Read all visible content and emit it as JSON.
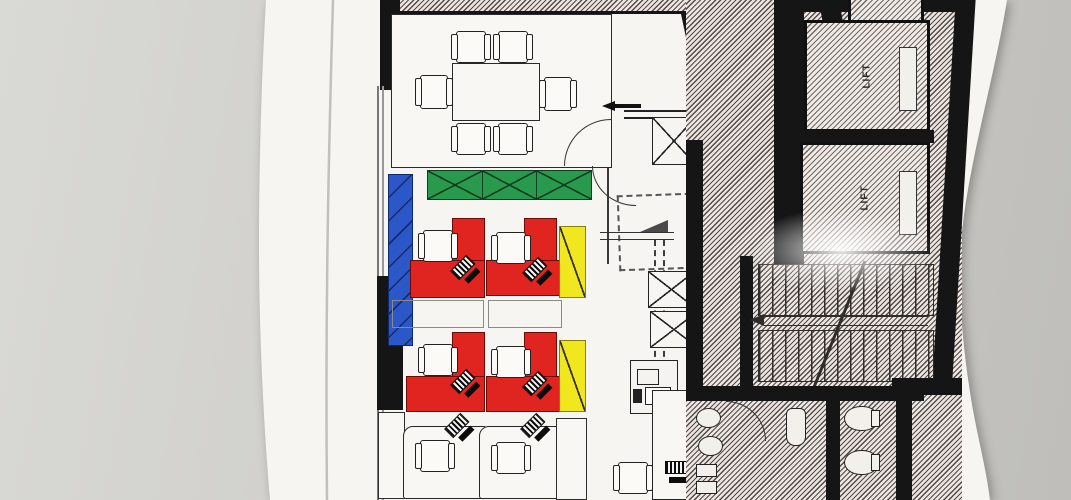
{
  "scene": {
    "background_color": "#cdccc8",
    "paper_color": "#f6f5f1"
  },
  "plan": {
    "highlight_colors": {
      "red_desks": "#e02420",
      "yellow_panels": "#f1e71f",
      "blue_cabinet": "#2b57c8",
      "green_cabinet": "#28994d"
    },
    "lifts": [
      {
        "label": "LIFT"
      },
      {
        "label": "LIFT"
      }
    ]
  }
}
